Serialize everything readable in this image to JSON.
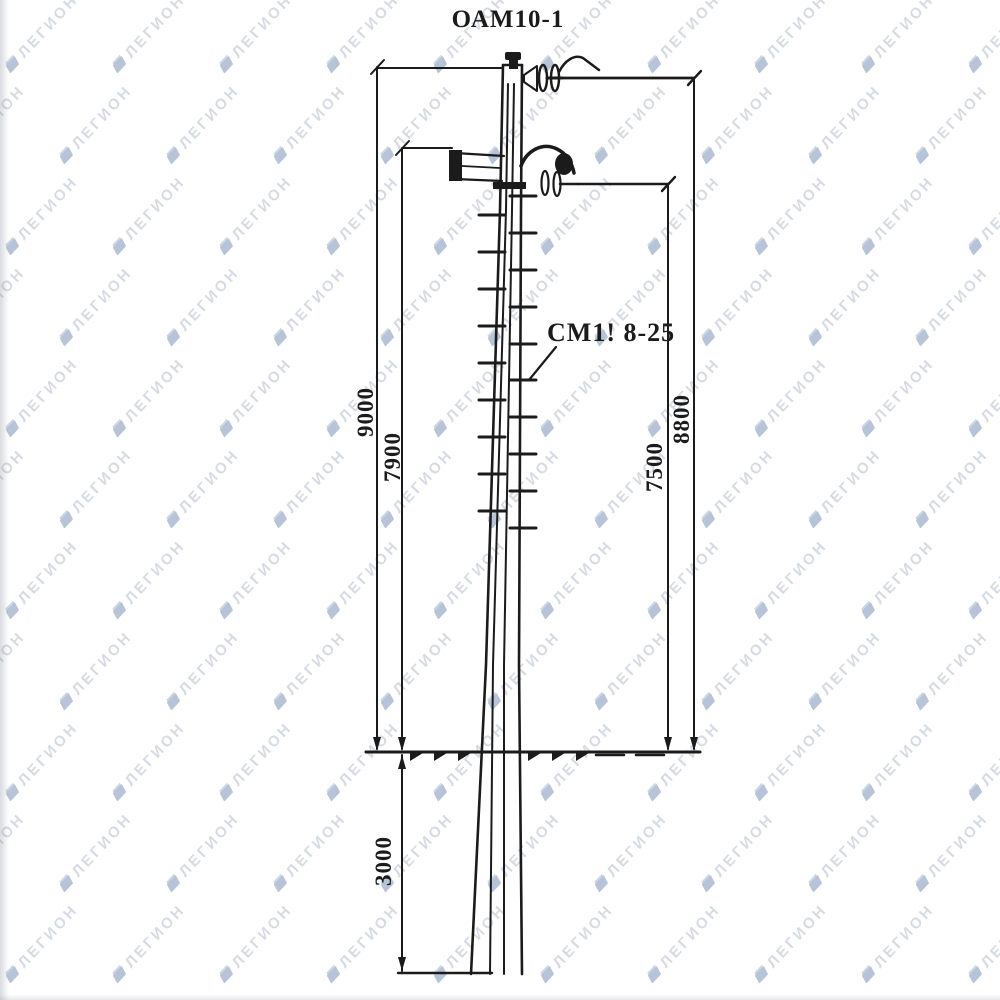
{
  "watermark": {
    "text": "ЛЕГИОН",
    "text_color": "#9aa7ba",
    "icon": "flag-icon",
    "icon_color": "#7d95b8"
  },
  "diagram": {
    "title": "ОАМ10-1",
    "callout_label": "СМ1! 8-25",
    "ink_color": "#1b1b1b",
    "dimensions": {
      "left_outer": "9000",
      "left_inner": "7900",
      "right_inner": "7500",
      "right_outer": "8800",
      "underground": "3000"
    }
  }
}
